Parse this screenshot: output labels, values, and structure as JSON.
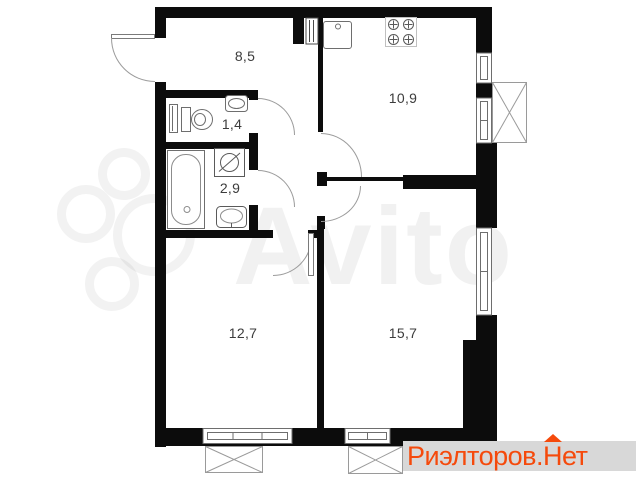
{
  "plan": {
    "rooms": {
      "hallway": {
        "area": "8,5"
      },
      "kitchen": {
        "area": "10,9"
      },
      "wc": {
        "area": "1,4"
      },
      "bathroom": {
        "area": "2,9"
      },
      "room_small": {
        "area": "12,7"
      },
      "room_large": {
        "area": "15,7"
      }
    },
    "fixtures": [
      "entrance-door",
      "kitchen-sink",
      "stove",
      "vent-shaft",
      "radiator",
      "toilet",
      "washbasin",
      "bathtub",
      "washing-machine",
      "window",
      "balcony-hatch"
    ]
  },
  "watermark": {
    "brand": "Avito"
  },
  "footer": {
    "prefix": "Риэлторов.",
    "house_letter": "Н",
    "suffix": "ет",
    "accent_color": "#f54a0c",
    "band_color": "#d8d8d8"
  },
  "colors": {
    "wall": "#0c0c0c",
    "fixture_line": "#6e6e6e",
    "label": "#3c3c3c"
  }
}
